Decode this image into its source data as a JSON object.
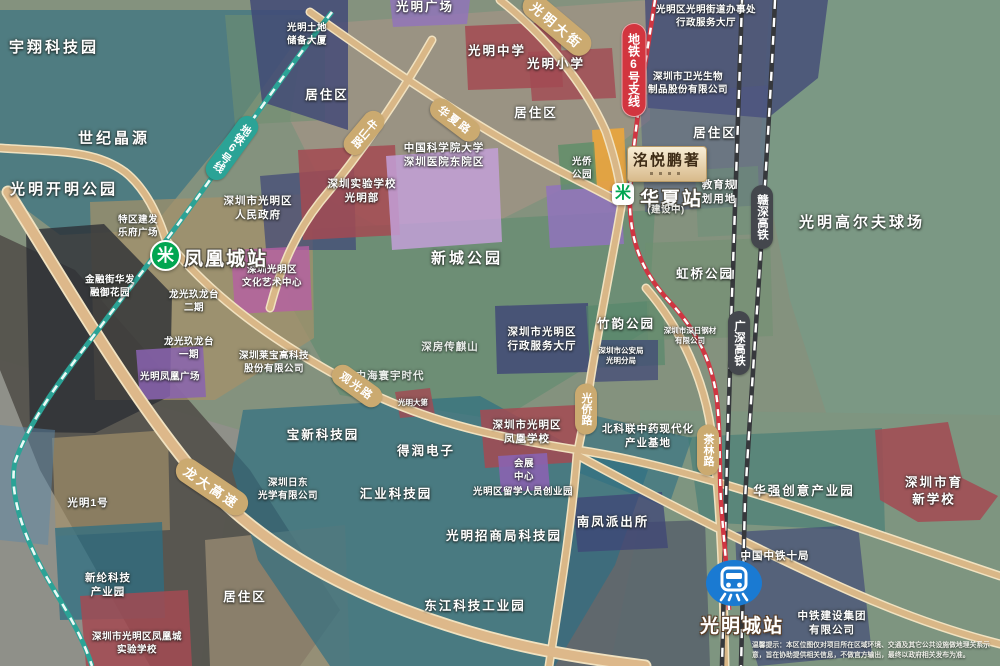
{
  "map": {
    "labels": [
      {
        "name": "label-yuxiang-tech-park",
        "text": "宇翔科技园",
        "x": 54,
        "y": 48,
        "kind": "xl"
      },
      {
        "name": "label-shiji-jingyuan",
        "text": "世纪晶源",
        "x": 114,
        "y": 139,
        "kind": "xl"
      },
      {
        "name": "label-guangming-kaiming-park",
        "text": "光明开明公园",
        "x": 64,
        "y": 190,
        "kind": "xl"
      },
      {
        "name": "label-guangming-plaza",
        "text": "光明广场",
        "x": 425,
        "y": 7,
        "kind": "lg"
      },
      {
        "name": "label-land-reserve-building",
        "text": "光明土地\n储备大厦",
        "x": 307,
        "y": 35,
        "kind": "sm"
      },
      {
        "name": "label-residential-1",
        "text": "居住区",
        "x": 327,
        "y": 95,
        "kind": "lg"
      },
      {
        "name": "label-residential-2",
        "text": "居住区",
        "x": 536,
        "y": 113,
        "kind": "lg"
      },
      {
        "name": "label-residential-3",
        "text": "居住区",
        "x": 715,
        "y": 133,
        "kind": "lg"
      },
      {
        "name": "label-residential-4",
        "text": "居住区",
        "x": 245,
        "y": 597,
        "kind": "lg"
      },
      {
        "name": "label-guangming-middle-school",
        "text": "光明中学",
        "x": 497,
        "y": 51,
        "kind": "lg"
      },
      {
        "name": "label-guangming-primary-school",
        "text": "光明小学",
        "x": 556,
        "y": 64,
        "kind": "lg"
      },
      {
        "name": "label-street-office",
        "text": "光明区光明街道办事处\n行政服务大厅",
        "x": 706,
        "y": 17,
        "kind": "sm"
      },
      {
        "name": "label-weiguang-bio",
        "text": "深圳市卫光生物\n制品股份有限公司",
        "x": 688,
        "y": 84,
        "kind": "sm"
      },
      {
        "name": "label-cas-hospital",
        "text": "中国科学院大学\n深圳医院东院区",
        "x": 444,
        "y": 156,
        "kind": "md"
      },
      {
        "name": "label-shenzhen-experimental-school",
        "text": "深圳实验学校\n光明部",
        "x": 362,
        "y": 192,
        "kind": "md"
      },
      {
        "name": "label-district-government",
        "text": "深圳市光明区\n人民政府",
        "x": 258,
        "y": 209,
        "kind": "md"
      },
      {
        "name": "label-education-planned-land",
        "text": "教育规\n划用地",
        "x": 719,
        "y": 193,
        "kind": "md"
      },
      {
        "name": "label-guangqiao-park",
        "text": "光侨\n公园",
        "x": 582,
        "y": 169,
        "kind": "sm"
      },
      {
        "name": "label-golf-course",
        "text": "光明高尔夫球场",
        "x": 862,
        "y": 223,
        "kind": "xl"
      },
      {
        "name": "label-hongqiao-park",
        "text": "虹桥公园",
        "x": 705,
        "y": 274,
        "kind": "lg"
      },
      {
        "name": "label-tequ-jianfa",
        "text": "特区建发\n乐府广场",
        "x": 138,
        "y": 227,
        "kind": "sm"
      },
      {
        "name": "label-jinrongjie",
        "text": "金融街华发\n融御花园",
        "x": 110,
        "y": 287,
        "kind": "sm"
      },
      {
        "name": "label-longguang-2",
        "text": "龙光玖龙台\n二期",
        "x": 194,
        "y": 302,
        "kind": "sm"
      },
      {
        "name": "label-longguang-1",
        "text": "龙光玖龙台\n一期",
        "x": 189,
        "y": 349,
        "kind": "sm"
      },
      {
        "name": "label-fenghuang-plaza",
        "text": "光明凤凰广场",
        "x": 170,
        "y": 378,
        "kind": "sm"
      },
      {
        "name": "label-culture-art-center",
        "text": "深圳光明区\n文化艺术中心",
        "x": 272,
        "y": 277,
        "kind": "sm"
      },
      {
        "name": "label-laibao-tech",
        "text": "深圳莱宝高科技\n股份有限公司",
        "x": 274,
        "y": 363,
        "kind": "sm"
      },
      {
        "name": "label-xincheng-park",
        "text": "新城公园",
        "x": 467,
        "y": 259,
        "kind": "xl"
      },
      {
        "name": "label-shenfang-chuanqishan",
        "text": "深房传麒山",
        "x": 450,
        "y": 348,
        "kind": "md k-dim"
      },
      {
        "name": "label-zhonghai-huanyu",
        "text": "中海寰宇时代",
        "x": 390,
        "y": 377,
        "kind": "md k-dim"
      },
      {
        "name": "label-admin-service-hall",
        "text": "深圳市光明区\n行政服务大厅",
        "x": 542,
        "y": 340,
        "kind": "md"
      },
      {
        "name": "label-zhuyun-park",
        "text": "竹韵公园",
        "x": 626,
        "y": 324,
        "kind": "lg"
      },
      {
        "name": "label-police-bureau",
        "text": "深圳市公安局\n光明分局",
        "x": 621,
        "y": 356,
        "kind": "xs"
      },
      {
        "name": "label-steel-company",
        "text": "深圳市深日钢材\n有限公司",
        "x": 690,
        "y": 336,
        "kind": "xs"
      },
      {
        "name": "label-beikelian",
        "text": "北科联中药现代化\n产业基地",
        "x": 648,
        "y": 437,
        "kind": "md"
      },
      {
        "name": "label-baoxin-tech-park",
        "text": "宝新科技园",
        "x": 323,
        "y": 435,
        "kind": "lg"
      },
      {
        "name": "label-derun-electronics",
        "text": "得润电子",
        "x": 426,
        "y": 451,
        "kind": "lg"
      },
      {
        "name": "label-nitto-optical",
        "text": "深圳日东\n光学有限公司",
        "x": 288,
        "y": 490,
        "kind": "sm"
      },
      {
        "name": "label-huiye-tech-park",
        "text": "汇业科技园",
        "x": 396,
        "y": 494,
        "kind": "lg"
      },
      {
        "name": "label-fenghuang-school",
        "text": "深圳市光明区\n凤凰学校",
        "x": 527,
        "y": 433,
        "kind": "md"
      },
      {
        "name": "label-exhibition-center",
        "text": "会展\n中心",
        "x": 524,
        "y": 471,
        "kind": "sm"
      },
      {
        "name": "label-returnee-park",
        "text": "光明区留学人员创业园",
        "x": 523,
        "y": 493,
        "kind": "sm"
      },
      {
        "name": "label-merchants-tech-park",
        "text": "光明招商局科技园",
        "x": 504,
        "y": 536,
        "kind": "lg"
      },
      {
        "name": "label-dongjiang-industrial",
        "text": "东江科技工业园",
        "x": 475,
        "y": 606,
        "kind": "lg"
      },
      {
        "name": "label-nanfeng-police",
        "text": "南凤派出所",
        "x": 613,
        "y": 522,
        "kind": "lg"
      },
      {
        "name": "label-huaqiang-creative",
        "text": "华强创意产业园",
        "x": 804,
        "y": 491,
        "kind": "lg"
      },
      {
        "name": "label-yuxin-school",
        "text": "深圳市育新学校",
        "x": 934,
        "y": 491,
        "kind": "lg"
      },
      {
        "name": "label-zhongtie-10th",
        "text": "中国中铁十局",
        "x": 775,
        "y": 557,
        "kind": "md"
      },
      {
        "name": "label-zhongtie-construction",
        "text": "中铁建设集团\n有限公司",
        "x": 832,
        "y": 624,
        "kind": "md"
      },
      {
        "name": "label-guangming-no1",
        "text": "光明1号",
        "x": 88,
        "y": 504,
        "kind": "md"
      },
      {
        "name": "label-xinlun-tech-park",
        "text": "新纶科技\n产业园",
        "x": 108,
        "y": 586,
        "kind": "md"
      },
      {
        "name": "label-fenghuangcheng-exp-school",
        "text": "深圳市光明区凤凰城\n实验学校",
        "x": 137,
        "y": 644,
        "kind": "sm"
      },
      {
        "name": "label-guangming-dadi",
        "text": "光明大第",
        "x": 413,
        "y": 403,
        "kind": "xs"
      }
    ],
    "road_pills": [
      {
        "name": "road-pill-guanguang-road",
        "text": "观光路",
        "x": 357,
        "y": 386,
        "rot": 36,
        "style": "h"
      },
      {
        "name": "road-pill-longda-expressway",
        "text": "龙大高速",
        "x": 212,
        "y": 487,
        "rot": 34,
        "style": "h big"
      },
      {
        "name": "road-pill-huaxia-road",
        "text": "华夏路",
        "x": 455,
        "y": 120,
        "rot": 37,
        "style": "h"
      },
      {
        "name": "road-pill-guangming-street",
        "text": "光明大街",
        "x": 557,
        "y": 25,
        "rot": 40,
        "style": "h big"
      },
      {
        "name": "road-pill-niushan-road",
        "text": "牛山路",
        "x": 364,
        "y": 133,
        "rot": 40,
        "style": "v"
      },
      {
        "name": "metro-pill-line6",
        "text": "地铁6号线",
        "x": 232,
        "y": 148,
        "rot": 36,
        "style": "v teal"
      },
      {
        "name": "road-pill-guangqiao-road",
        "text": "光侨路",
        "x": 586,
        "y": 409,
        "rot": 0,
        "style": "v"
      },
      {
        "name": "road-pill-chalin-road",
        "text": "茶林路",
        "x": 708,
        "y": 450,
        "rot": 0,
        "style": "v"
      },
      {
        "name": "metro-pill-line6-branch",
        "text": "地铁6号支线",
        "x": 634,
        "y": 70,
        "rot": 0,
        "style": "v red"
      },
      {
        "name": "rail-pill-ganshen",
        "text": "赣深高铁",
        "x": 762,
        "y": 217,
        "rot": 0,
        "style": "v dark"
      },
      {
        "name": "rail-pill-guangshen",
        "text": "广深高铁",
        "x": 739,
        "y": 343,
        "rot": 0,
        "style": "v dark"
      }
    ],
    "stations": {
      "fenghuangcheng": {
        "label": "凤凰城站"
      },
      "huaxia": {
        "label": "华夏站",
        "status": "(建设中)"
      },
      "guangmingcheng": {
        "label": "光明城站"
      }
    },
    "logo": {
      "text": "洺悦鹏著"
    },
    "disclaimer": "温馨提示：本区位图仅对项目所在区域环境、交通及其它公共设施做地理关系示意，旨在协助提供相关信息，不做官方输出，最终以政府相关发布为准。"
  },
  "icons": {
    "metro_glyph": "米"
  },
  "colors": {
    "metro_green": "#00a651",
    "line6_teal": "#2ba396",
    "branch_red": "#cf3642",
    "railway_dark": "#36383c",
    "road_tan": "#d9b787",
    "station_blue": "#1a7ad2",
    "logo_cream": "#f8eed6"
  }
}
